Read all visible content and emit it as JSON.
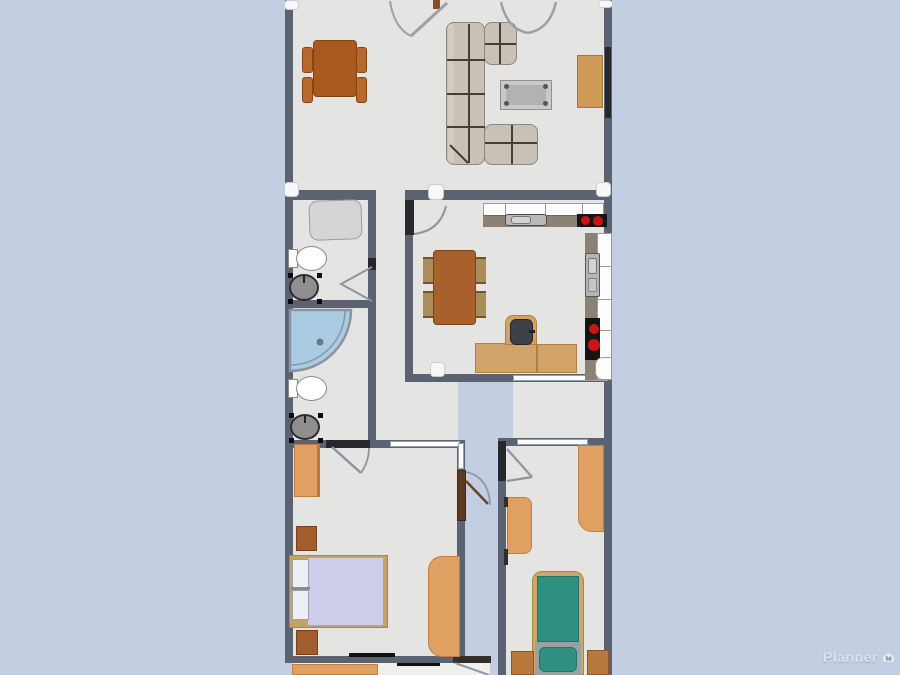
{
  "app": {
    "watermark": {
      "brand": "Planner",
      "badge": "5d"
    }
  },
  "palette": {
    "background": "#c3cee2",
    "floor": "#e4e4e2",
    "wall": "#5b6271",
    "furniture_orange": "#dfa061",
    "furniture_brown": "#a15d2c",
    "table_wood": "#a8591d",
    "sofa_beige": "#c8c1b7",
    "countertop_taupe": "#8b8274",
    "stove_burner_red": "#cc1414",
    "shower_glass_blue": "#a9cce3",
    "bed_mattress_lavender": "#cdcee9",
    "bed_mattress_teal": "#2f9080"
  },
  "plan": {
    "rooms": [
      {
        "name": "living-dining-room",
        "furniture": [
          "dining-table",
          "dining-chair x4",
          "corner-sofa",
          "coffee-table",
          "desk",
          "wall-tv",
          "double-door",
          "entry-door"
        ]
      },
      {
        "name": "wc-room",
        "furniture": [
          "bathtub",
          "toilet",
          "washing-machine",
          "door"
        ]
      },
      {
        "name": "shower-room",
        "furniture": [
          "corner-shower",
          "toilet",
          "washing-machine"
        ]
      },
      {
        "name": "kitchen",
        "furniture": [
          "upper-cabinets",
          "countertop",
          "sink",
          "stove-2-burner",
          "side-counter",
          "side-sink",
          "side-stove",
          "dining-table",
          "chair x4",
          "office-desk",
          "office-chair",
          "door"
        ]
      },
      {
        "name": "hallway",
        "furniture": []
      },
      {
        "name": "balcony",
        "furniture": []
      },
      {
        "name": "bedroom-left",
        "furniture": [
          "wardrobe",
          "nightstand x2",
          "double-bed",
          "desk",
          "door",
          "exterior-door",
          "window x2"
        ]
      },
      {
        "name": "bedroom-right",
        "furniture": [
          "desk",
          "cabinet",
          "single-bed-teal",
          "nightstand x2",
          "door",
          "window"
        ]
      },
      {
        "name": "lower-room",
        "furniture": [
          "bed-partial",
          "door"
        ]
      }
    ]
  }
}
